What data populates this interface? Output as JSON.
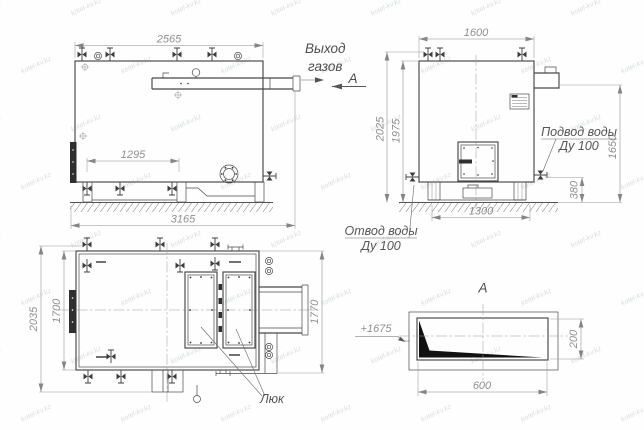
{
  "watermark": {
    "text": "kotel-kv.kz"
  },
  "side_view": {
    "width_dim": "2565",
    "valve_span_dim": "1295",
    "base_dim": "3165",
    "gas_outlet_line1": "Выход",
    "gas_outlet_line2": "газов",
    "section_mark": "А"
  },
  "front_view": {
    "width_dim": "1600",
    "height_total_dim": "2025",
    "height_body_dim": "1975",
    "outlet_height_dim": "1650",
    "drain_height_dim": "380",
    "base_width_dim": "1300",
    "water_supply_line1": "Подвод воды",
    "water_supply_line2": "Ду 100",
    "water_drain_line1": "Отвод воды",
    "water_drain_line2": "Ду 100"
  },
  "plan_view": {
    "depth_total_dim": "2035",
    "depth_body_dim": "1700",
    "depth_right_dim": "1770",
    "hatch_label": "Люк"
  },
  "section_view": {
    "title": "А",
    "elevation_mark": "+1675",
    "width_dim": "600",
    "height_dim": "200"
  }
}
